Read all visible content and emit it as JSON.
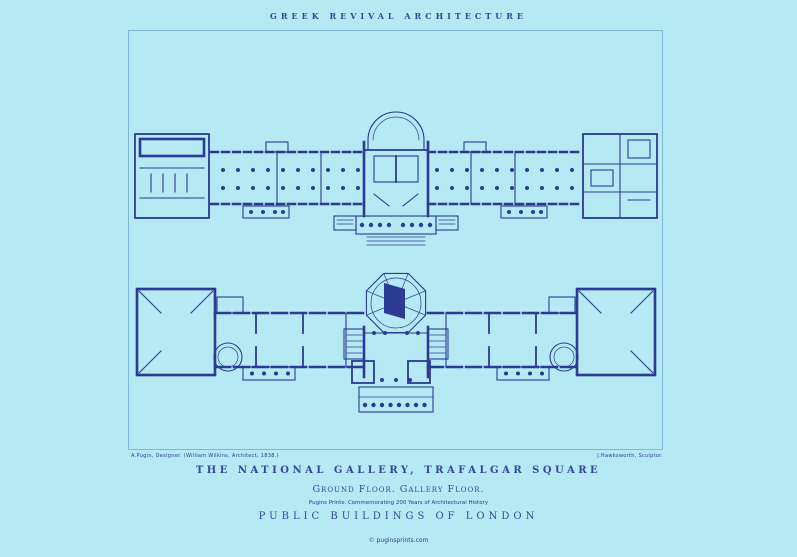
{
  "poster": {
    "header": "GREEK REVIVAL ARCHITECTURE",
    "credit_left": "A.Pugin, Designer. (William Wilkins, Architect, 1838.)",
    "credit_right": "J.Hawksworth, Sculptor.",
    "title": "THE NATIONAL GALLERY, TRAFALGAR SQUARE",
    "subtitle": "Ground Floor. Gallery Floor.",
    "tagline": "Pugins Prints: Commemorating 200 Years of Architectural History",
    "series": "PUBLIC BUILDINGS OF LONDON",
    "footer": "© puginsprints.com",
    "plans": [
      {
        "name": "ground-floor-plan",
        "label": "Ground Floor"
      },
      {
        "name": "gallery-floor-plan",
        "label": "Gallery Floor"
      }
    ]
  },
  "colors": {
    "background": "#b5eaf4",
    "ink": "#2b3a94",
    "frame": "#7fb7d4",
    "text": "#3646a0"
  }
}
